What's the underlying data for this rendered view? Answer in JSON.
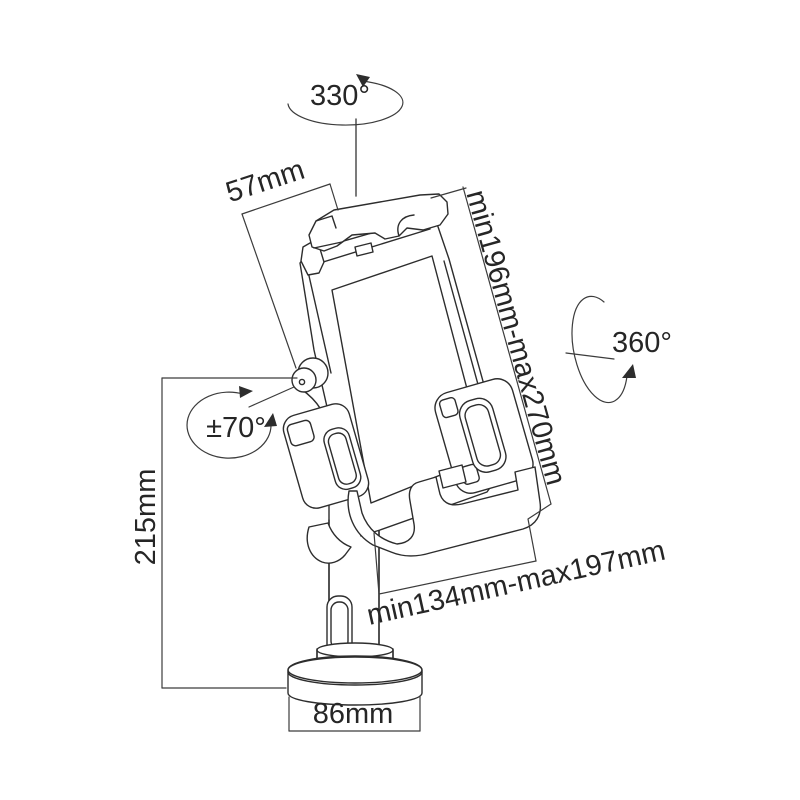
{
  "drawing": {
    "background": "#ffffff",
    "line_color": "#2d2d2d",
    "dimension_line_color": "#3c3c3c",
    "text_color": "#262626",
    "labels": {
      "rotation_top": "330°",
      "clamp_depth": "57mm",
      "height_range": "min196mm-max270mm",
      "swivel": "360°",
      "tilt": "±70°",
      "pole_height": "215mm",
      "depth_range": "min134mm-max197mm",
      "base_diameter": "86mm"
    }
  }
}
